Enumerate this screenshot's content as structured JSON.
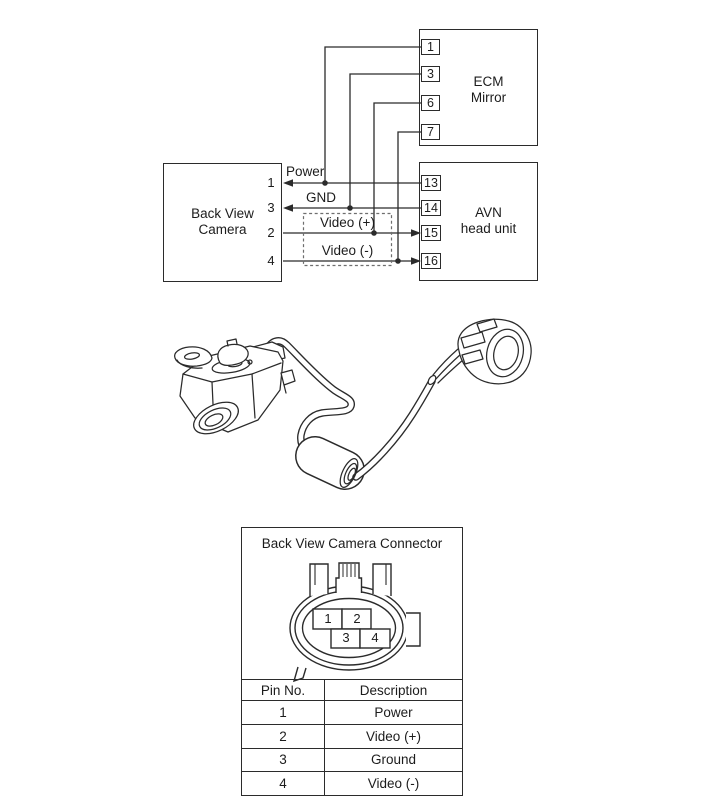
{
  "diagram": {
    "ecm": {
      "title": [
        "ECM",
        "Mirror"
      ],
      "pins": [
        "1",
        "3",
        "6",
        "7"
      ]
    },
    "avn": {
      "title": [
        "AVN",
        "head unit"
      ],
      "pins": [
        "13",
        "14",
        "15",
        "16"
      ]
    },
    "camera": {
      "title": [
        "Back View",
        "Camera"
      ],
      "pins": [
        "1",
        "3",
        "2",
        "4"
      ]
    },
    "wires": [
      {
        "label": "Power"
      },
      {
        "label": "GND"
      },
      {
        "label": "Video (+)"
      },
      {
        "label": "Video (-)"
      }
    ]
  },
  "connector_panel": {
    "title": "Back View Camera Connector",
    "connector_pins": [
      "1",
      "2",
      "3",
      "4"
    ],
    "table": {
      "headers": [
        "Pin No.",
        "Description"
      ],
      "rows": [
        [
          "1",
          "Power"
        ],
        [
          "2",
          "Video (+)"
        ],
        [
          "3",
          "Ground"
        ],
        [
          "4",
          "Video (-)"
        ]
      ]
    }
  },
  "colors": {
    "line": "#2b2b2b",
    "background": "#ffffff"
  }
}
